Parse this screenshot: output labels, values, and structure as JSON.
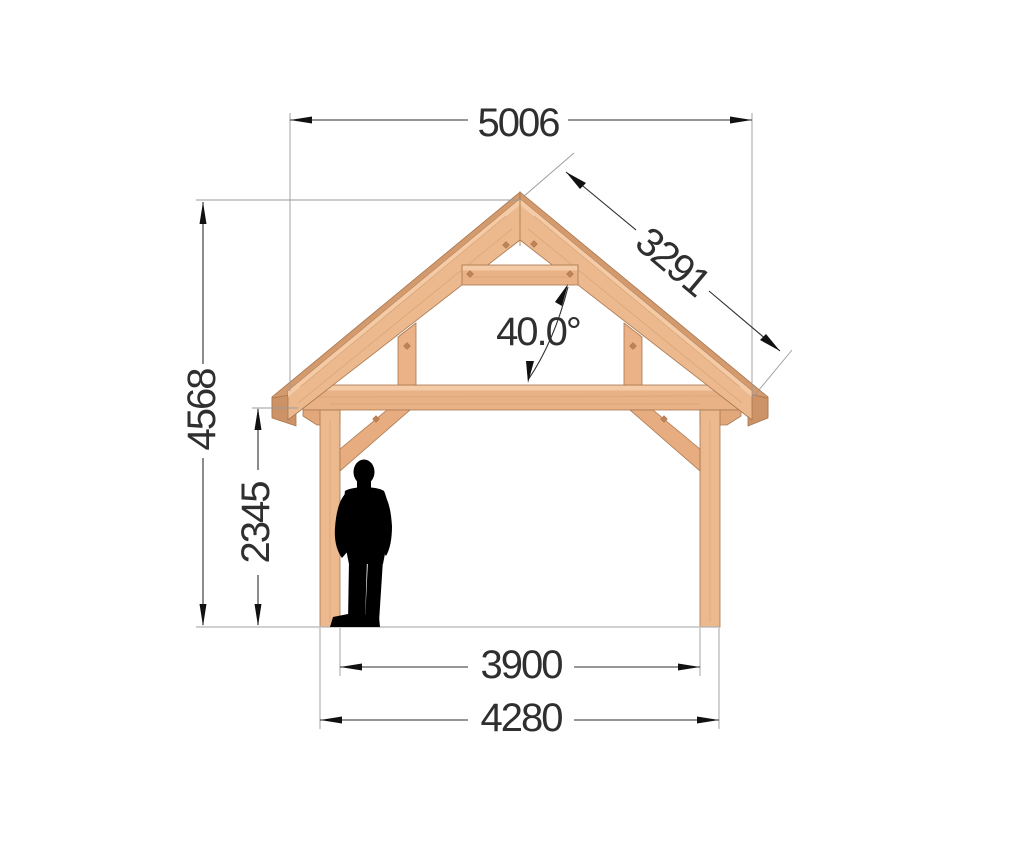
{
  "drawing": {
    "title": "timber-frame-front-elevation",
    "dimensions": {
      "roof_overall_width": "5006",
      "rafter_length": "3291",
      "roof_angle": "40.0°",
      "overall_height": "4568",
      "eave_clear_height": "2345",
      "posts_inner_span": "3900",
      "posts_outer_span": "4280"
    },
    "colors": {
      "wood_face": "#ecb98e",
      "wood_top": "#f4cba6",
      "wood_back": "#d39a6d",
      "dimension_line": "#2e2e2e",
      "extension_line": "#9a9a9a",
      "silhouette": "#000000",
      "background": "#ffffff"
    }
  }
}
